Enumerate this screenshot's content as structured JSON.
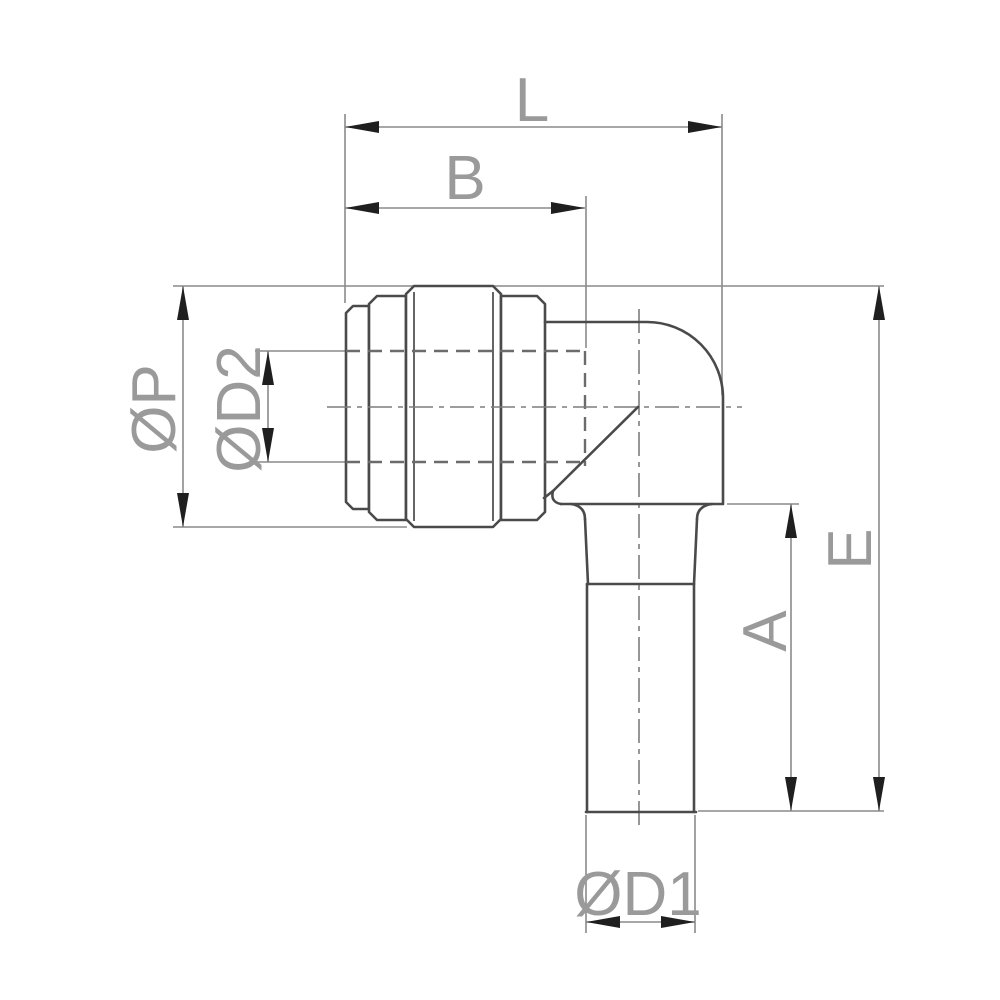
{
  "canvas": {
    "width": 1000,
    "height": 1000,
    "background": "#ffffff"
  },
  "labels": {
    "overall_length": "L",
    "collet_length": "B",
    "collet_outer_diameter": "ØP",
    "bore_diameter": "ØD2",
    "overall_height": "E",
    "stem_length": "A",
    "stem_diameter": "ØD1"
  },
  "colors": {
    "background": "#ffffff",
    "object_line": "#4a4a4a",
    "hidden_line": "#6b6b6b",
    "center_line": "#7d7d7d",
    "dimension_line": "#8a8a8a",
    "arrow": "#1f1f1f",
    "text": "#9a9a9a"
  }
}
